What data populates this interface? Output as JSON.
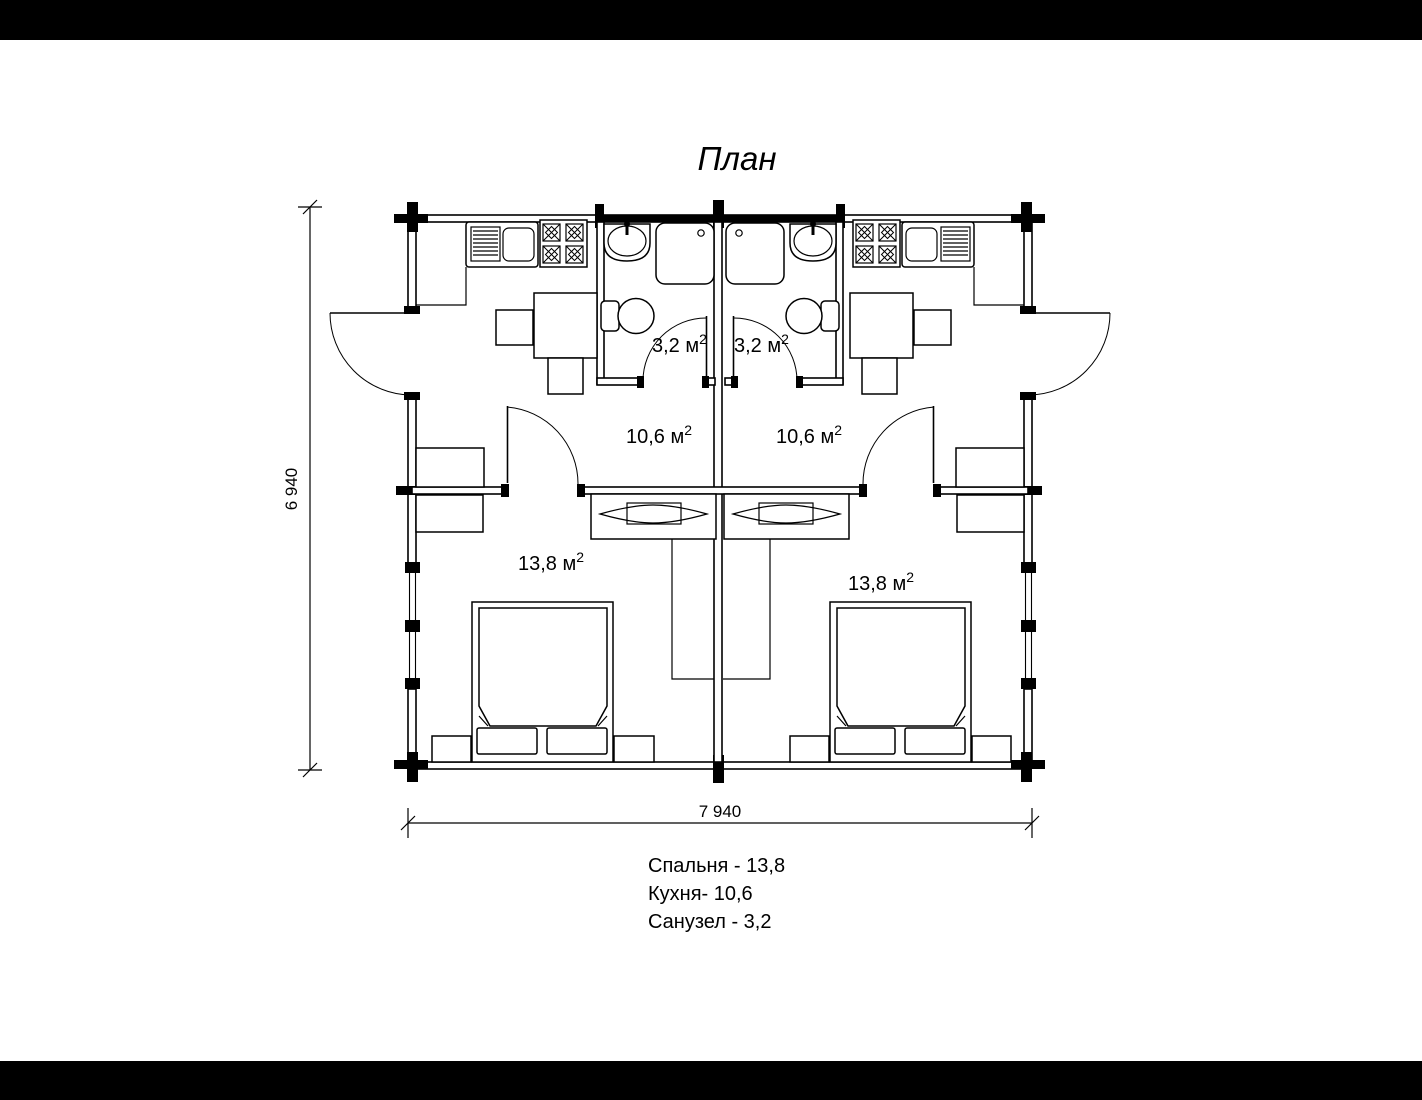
{
  "title": "План",
  "labels": {
    "bath_left": {
      "text": "3,2 м",
      "sup": "2"
    },
    "bath_right": {
      "text": "3,2 м",
      "sup": "2"
    },
    "kitchen_left": {
      "text": "10,6 м",
      "sup": "2"
    },
    "kitchen_right": {
      "text": "10,6 м",
      "sup": "2"
    },
    "bed_left": {
      "text": "13,8 м",
      "sup": "2"
    },
    "bed_right": {
      "text": "13,8 м",
      "sup": "2"
    }
  },
  "dimensions": {
    "height_label": "6 940",
    "width_label": "7 940"
  },
  "legend": {
    "bedroom": "Спальня - 13,8",
    "kitchen": "Кухня- 10,6",
    "bathroom": "Санузел - 3,2"
  },
  "colors": {
    "line": "#000000",
    "background": "#ffffff"
  }
}
